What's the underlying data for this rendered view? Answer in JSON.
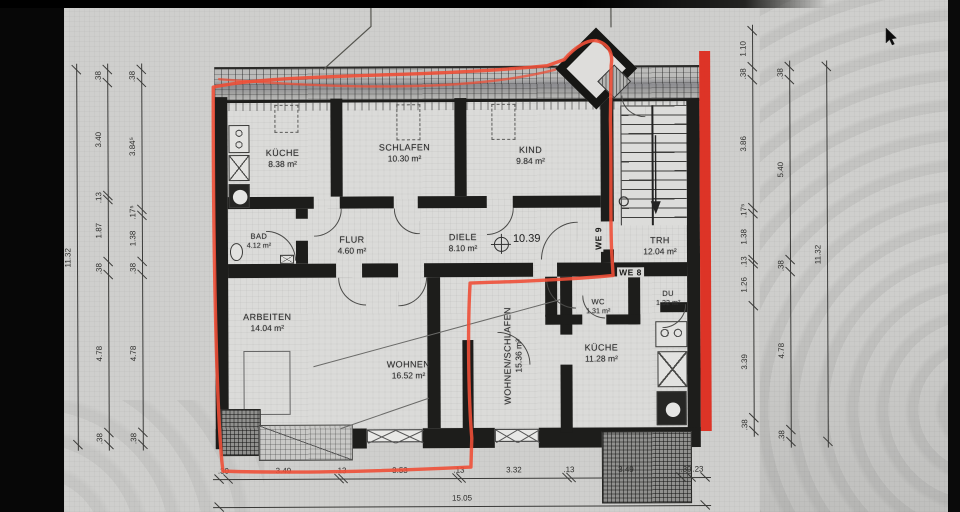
{
  "photo": {
    "type": "architectural-floorplan-photo",
    "cursor": "black-arrow",
    "plan": {
      "units": {
        "we9": "WE 9",
        "we8": "WE 8"
      },
      "level_marker": "10.39",
      "rooms": [
        {
          "id": "kueche_og",
          "name": "KÜCHE",
          "area": "8.38 m²"
        },
        {
          "id": "schlafen",
          "name": "SCHLAFEN",
          "area": "10.30 m²"
        },
        {
          "id": "kind",
          "name": "KIND",
          "area": "9.84 m²"
        },
        {
          "id": "bad",
          "name": "BAD",
          "area": "4.12 m²"
        },
        {
          "id": "flur",
          "name": "FLUR",
          "area": "4.60 m²"
        },
        {
          "id": "diele",
          "name": "DIELE",
          "area": "8.10 m²"
        },
        {
          "id": "trh",
          "name": "TRH",
          "area": "12.04 m²"
        },
        {
          "id": "arbeiten",
          "name": "ARBEITEN",
          "area": "14.04 m²"
        },
        {
          "id": "wohnen",
          "name": "WOHNEN",
          "area": "16.52 m²"
        },
        {
          "id": "wohnen_schlafen",
          "name": "WOHNEN/SCHLAFEN",
          "area": "15.36 m²"
        },
        {
          "id": "kueche_eg",
          "name": "KÜCHE",
          "area": "11.28 m²"
        },
        {
          "id": "wc",
          "name": "WC",
          "area": "1.31 m²"
        },
        {
          "id": "du",
          "name": "DU",
          "area": "1.32 m²"
        }
      ],
      "dims": {
        "bottom": {
          "segments": [
            ".30",
            "3.49",
            ".13",
            "3.53",
            ".13",
            "3.32",
            ".13",
            "3.49",
            ".30",
            ".23"
          ],
          "total": "15.05"
        },
        "left": {
          "outer_total": "11.32",
          "middle": [
            ".38",
            "3.40",
            ".13",
            "1.87",
            ".38",
            "4.78",
            ".38"
          ],
          "inner": [
            ".38",
            "3.84⁵",
            ".17⁵",
            "1.38",
            ".38",
            "4.78",
            ".38"
          ]
        },
        "right": {
          "outer_total": "11.32",
          "inner": [
            "1.10",
            ".38",
            "3.86",
            ".17⁵",
            "1.38",
            ".13",
            "1.26",
            "3.39",
            ".38"
          ],
          "middle": [
            ".38",
            "5.40",
            ".38",
            "4.78",
            ".38"
          ]
        }
      },
      "colors": {
        "marker_red": "#ee4f37",
        "wall_stripe_red": "#dd2b1d"
      }
    }
  }
}
